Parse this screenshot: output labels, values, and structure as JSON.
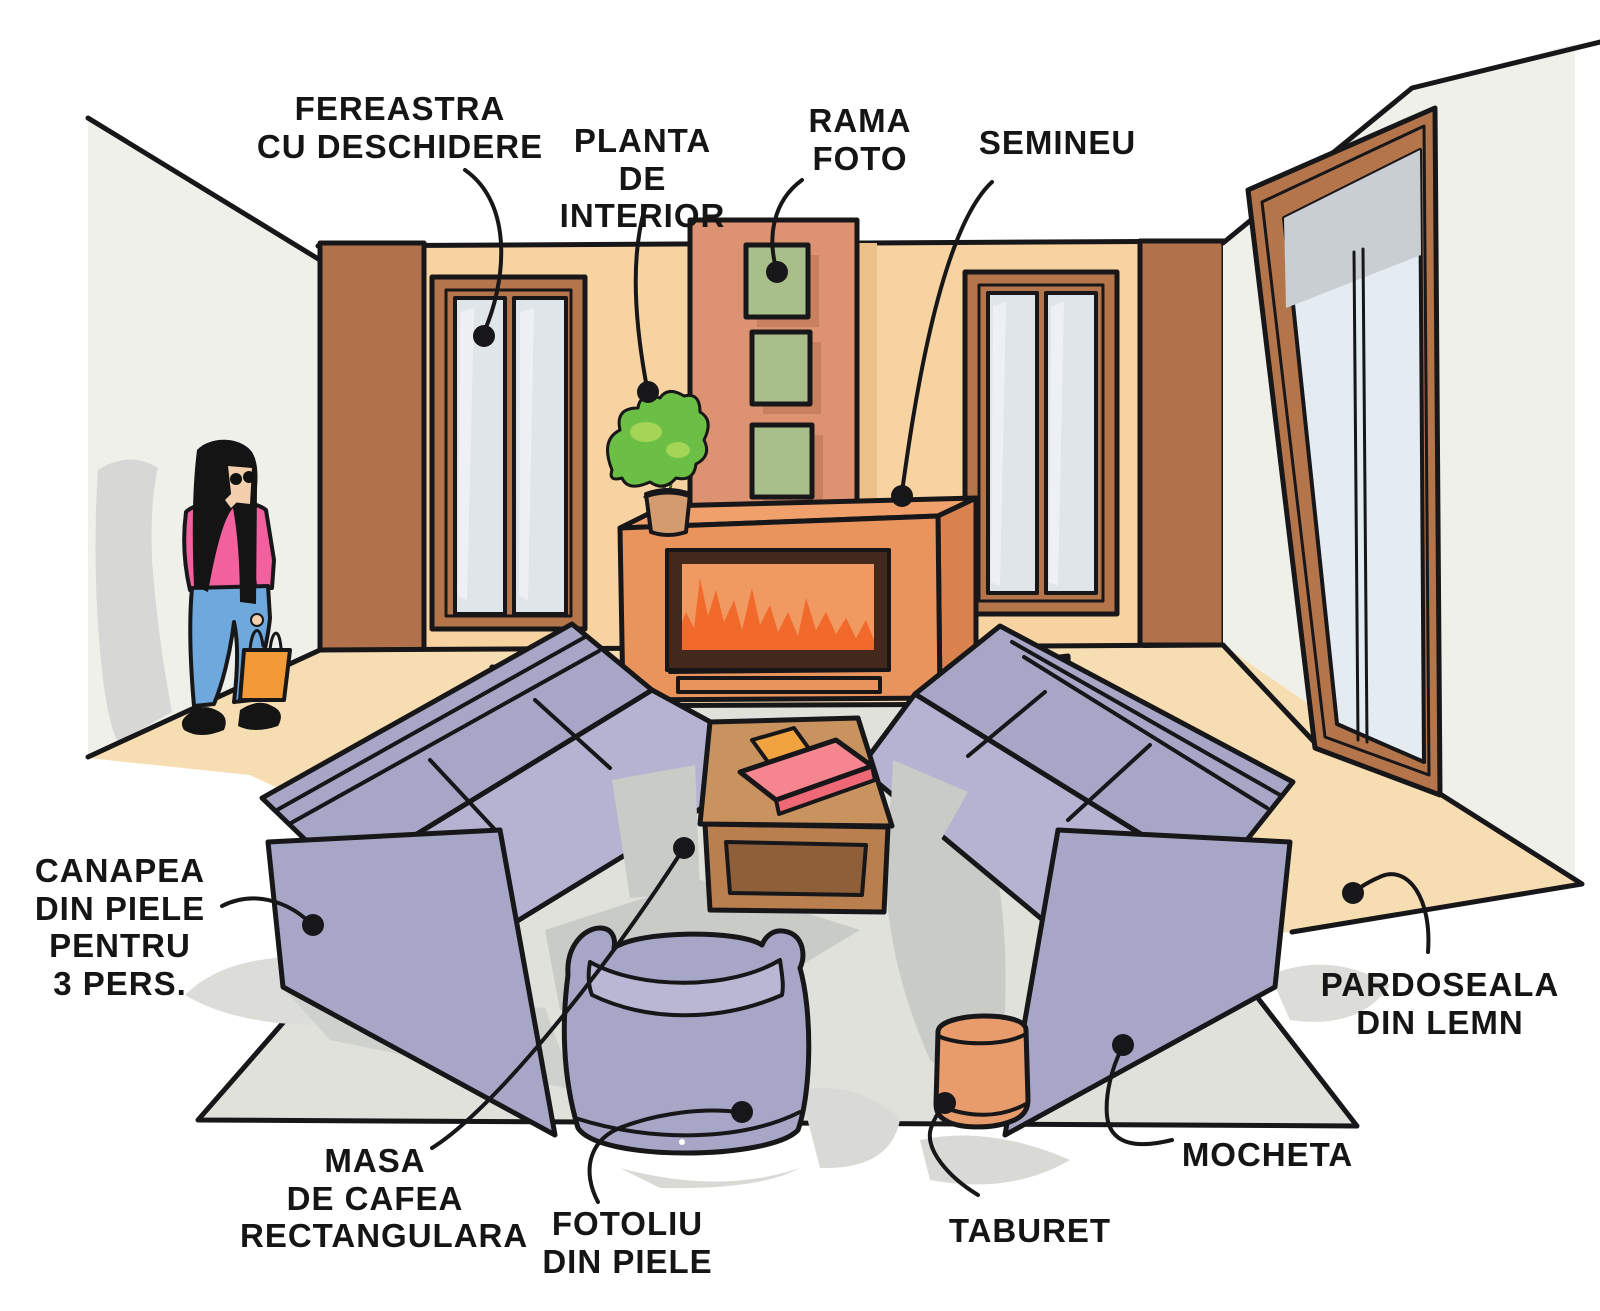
{
  "labels": {
    "fereastra": "FEREASTRA\nCU DESCHIDERE",
    "planta": "PLANTA\nDE INTERIOR",
    "rama": "RAMA\nFOTO",
    "semineu": "SEMINEU",
    "canapea": "CANAPEA\nDIN PIELE\nPENTRU\n3 PERS.",
    "pardoseala": "PARDOSEALA\nDIN LEMN",
    "masa": "MASA\nDE CAFEA\nRECTANGULARA",
    "fotoliu": "FOTOLIU\nDIN PIELE",
    "taburet": "TABURET",
    "mocheta": "MOCHETA"
  },
  "palette": {
    "outline": "#17171a",
    "back_wall_peach": "#f7d3a2",
    "side_wall_gray": "#eef0e9",
    "pillar_brown": "#b0714b",
    "window_frame_brown": "#b5754a",
    "glass_gray": "#dfe5e9",
    "chimney_terracotta": "#dd9372",
    "photo_frame_green": "#a9bf8a",
    "fireplace_orange": "#e9945d",
    "flame_orange": "#f2692c",
    "sofa_lavender": "#a8a6c6",
    "carpet_gray": "#dfe1da",
    "wood_floor_tan": "#f7ddb2",
    "table_brown": "#c9935f",
    "stool_orange": "#e89b6b",
    "book_pink": "#f5868f",
    "bag_orange": "#f29a38",
    "shirt_pink": "#f2609e",
    "jeans_blue": "#6fa8dc"
  },
  "scene": {
    "objects": [
      "left-wall",
      "back-wall",
      "right-wall",
      "left-pillar",
      "right-pillar",
      "left-window",
      "right-window",
      "patio-door",
      "chimney",
      "photo-frames",
      "fireplace",
      "plant",
      "wood-floor",
      "carpet",
      "left-sofa",
      "right-sofa",
      "coffee-table",
      "book",
      "armchair",
      "stool",
      "woman"
    ]
  }
}
